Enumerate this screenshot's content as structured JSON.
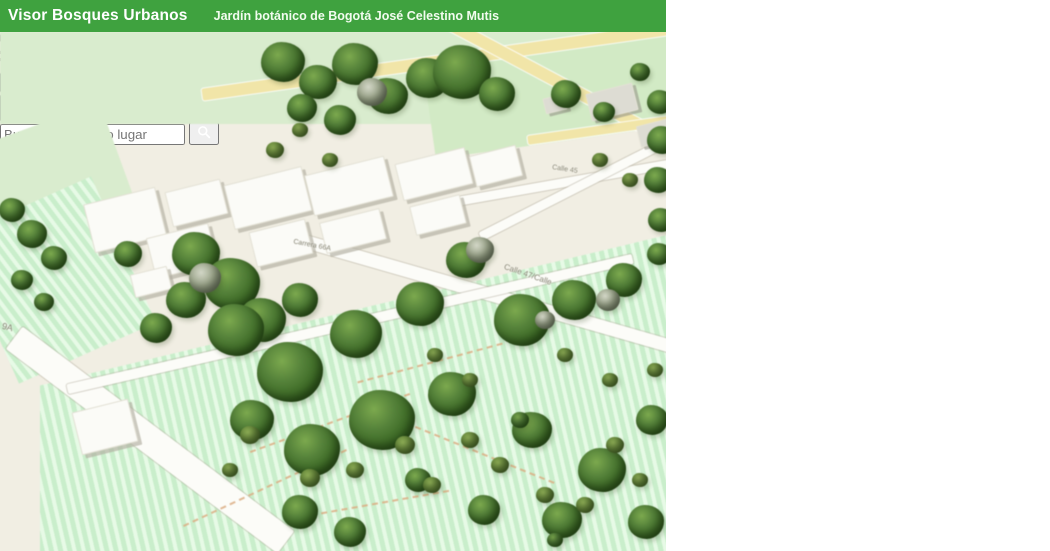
{
  "header": {
    "app_title": "Visor Bosques Urbanos",
    "map_title": "Jardín botánico de Bogotá José Celestino Mutis",
    "bar_color": "#3fa23f"
  },
  "search": {
    "placeholder": "cción o lugar",
    "sources_icon": "search-sources-icon",
    "caret_icon": "chevron-down-icon",
    "clear_icon": "clear-selection-icon",
    "submit_icon": "magnifier-icon"
  },
  "secondary_search": {
    "placeholder": "Buscar dirección o lugar",
    "submit_icon": "magnifier-icon"
  },
  "toolbar": {
    "buttons": [
      {
        "name": "measure-button",
        "icon": "ruler-icon",
        "color": "#44a543",
        "active": false
      },
      {
        "name": "search-tool-button",
        "icon": "magnifier-sparkle-icon",
        "color": "#2d5c2c",
        "active": true
      },
      {
        "name": "save-button",
        "icon": "save-disk-icon",
        "color": "#3f9e3e",
        "active": false
      }
    ]
  },
  "map": {
    "street_labels": [
      {
        "text": "Calle 45",
        "x": 552,
        "y": 134,
        "rot": 9,
        "size": 7
      },
      {
        "text": "Calle 47/Calle",
        "x": 503,
        "y": 238,
        "rot": 19,
        "size": 8
      },
      {
        "text": "Carrera 66A",
        "x": 293,
        "y": 210,
        "rot": 11,
        "size": 7
      },
      {
        "text": "9A",
        "x": 2,
        "y": 290,
        "rot": 14,
        "size": 9
      }
    ],
    "roads": [
      [
        435,
        30,
        470,
        12,
        -8,
        "y"
      ],
      [
        562,
        52,
        290,
        12,
        28,
        "y"
      ],
      [
        612,
        96,
        170,
        9,
        -8,
        "y"
      ],
      [
        490,
        262,
        440,
        13,
        16,
        "w"
      ],
      [
        150,
        408,
        340,
        28,
        37,
        "w"
      ],
      [
        565,
        150,
        250,
        9,
        -10,
        "w"
      ],
      [
        583,
        152,
        230,
        9,
        -27,
        "w"
      ],
      [
        350,
        292,
        580,
        10,
        -13,
        "w"
      ]
    ],
    "trails": [
      [
        330,
        390,
        170,
        -20
      ],
      [
        430,
        330,
        150,
        -15
      ],
      [
        265,
        455,
        180,
        -25
      ],
      [
        480,
        420,
        160,
        22
      ],
      [
        380,
        470,
        140,
        -10
      ]
    ],
    "buildings": [
      [
        88,
        163,
        72,
        48,
        "w"
      ],
      [
        150,
        198,
        62,
        40,
        "w"
      ],
      [
        168,
        153,
        55,
        34,
        "w"
      ],
      [
        228,
        143,
        78,
        44,
        "w"
      ],
      [
        308,
        133,
        80,
        40,
        "w"
      ],
      [
        398,
        123,
        70,
        36,
        "w"
      ],
      [
        252,
        193,
        56,
        34,
        "w"
      ],
      [
        322,
        183,
        60,
        30,
        "w"
      ],
      [
        412,
        168,
        50,
        28,
        "w"
      ],
      [
        472,
        118,
        46,
        30,
        "w"
      ],
      [
        132,
        238,
        36,
        22,
        "w"
      ],
      [
        76,
        373,
        56,
        42,
        "w"
      ],
      [
        588,
        56,
        46,
        26,
        "g"
      ],
      [
        638,
        90,
        32,
        20,
        "g"
      ],
      [
        544,
        64,
        20,
        14,
        "g"
      ]
    ],
    "trees": [
      [
        283,
        30,
        22,
        "d"
      ],
      [
        318,
        50,
        19,
        "d"
      ],
      [
        355,
        32,
        23,
        "d"
      ],
      [
        388,
        64,
        20,
        "d"
      ],
      [
        428,
        46,
        22,
        "d"
      ],
      [
        462,
        40,
        29,
        "d"
      ],
      [
        497,
        62,
        18,
        "d"
      ],
      [
        340,
        88,
        16,
        "d"
      ],
      [
        302,
        76,
        15,
        "d"
      ],
      [
        372,
        60,
        15,
        "g"
      ],
      [
        566,
        62,
        15,
        "d"
      ],
      [
        604,
        80,
        11,
        "d"
      ],
      [
        640,
        40,
        10,
        "d"
      ],
      [
        660,
        70,
        13,
        "d"
      ],
      [
        662,
        108,
        15,
        "d"
      ],
      [
        658,
        148,
        14,
        "d"
      ],
      [
        661,
        188,
        13,
        "d"
      ],
      [
        659,
        222,
        12,
        "d"
      ],
      [
        12,
        178,
        13,
        "d"
      ],
      [
        32,
        202,
        15,
        "d"
      ],
      [
        54,
        226,
        13,
        "d"
      ],
      [
        22,
        248,
        11,
        "d"
      ],
      [
        44,
        270,
        10,
        "d"
      ],
      [
        196,
        222,
        24,
        "d"
      ],
      [
        232,
        252,
        28,
        "d"
      ],
      [
        186,
        268,
        20,
        "d"
      ],
      [
        262,
        288,
        24,
        "d"
      ],
      [
        300,
        268,
        18,
        "d"
      ],
      [
        156,
        296,
        16,
        "d"
      ],
      [
        128,
        222,
        14,
        "d"
      ],
      [
        205,
        246,
        16,
        "g"
      ],
      [
        236,
        298,
        28,
        "d"
      ],
      [
        290,
        340,
        33,
        "d"
      ],
      [
        356,
        302,
        26,
        "d"
      ],
      [
        420,
        272,
        24,
        "d"
      ],
      [
        466,
        228,
        20,
        "d"
      ],
      [
        522,
        288,
        28,
        "d"
      ],
      [
        574,
        268,
        22,
        "d"
      ],
      [
        624,
        248,
        18,
        "d"
      ],
      [
        480,
        218,
        14,
        "g"
      ],
      [
        608,
        268,
        12,
        "g"
      ],
      [
        545,
        288,
        10,
        "g"
      ],
      [
        382,
        388,
        33,
        "d"
      ],
      [
        312,
        418,
        28,
        "d"
      ],
      [
        252,
        388,
        22,
        "d"
      ],
      [
        452,
        362,
        24,
        "d"
      ],
      [
        532,
        398,
        20,
        "d"
      ],
      [
        602,
        438,
        24,
        "d"
      ],
      [
        652,
        388,
        16,
        "d"
      ],
      [
        562,
        488,
        20,
        "d"
      ],
      [
        484,
        478,
        16,
        "d"
      ],
      [
        418,
        448,
        13,
        "d"
      ],
      [
        646,
        490,
        18,
        "d"
      ],
      [
        300,
        480,
        18,
        "d"
      ],
      [
        350,
        500,
        16,
        "d"
      ],
      [
        250,
        403,
        10,
        "b"
      ],
      [
        310,
        446,
        10,
        "b"
      ],
      [
        355,
        438,
        9,
        "b"
      ],
      [
        405,
        413,
        10,
        "b"
      ],
      [
        432,
        453,
        9,
        "b"
      ],
      [
        470,
        408,
        9,
        "b"
      ],
      [
        500,
        433,
        9,
        "b"
      ],
      [
        545,
        463,
        9,
        "b"
      ],
      [
        585,
        473,
        9,
        "b"
      ],
      [
        615,
        413,
        9,
        "b"
      ],
      [
        640,
        448,
        8,
        "b"
      ],
      [
        470,
        348,
        8,
        "b"
      ],
      [
        435,
        323,
        8,
        "b"
      ],
      [
        565,
        323,
        8,
        "b"
      ],
      [
        610,
        348,
        8,
        "b"
      ],
      [
        655,
        338,
        8,
        "b"
      ],
      [
        230,
        438,
        8,
        "b"
      ],
      [
        275,
        118,
        9,
        "b"
      ],
      [
        300,
        98,
        8,
        "b"
      ],
      [
        330,
        128,
        8,
        "b"
      ],
      [
        600,
        128,
        8,
        "b"
      ],
      [
        630,
        148,
        8,
        "b"
      ],
      [
        520,
        388,
        9,
        "gb"
      ],
      [
        555,
        508,
        8,
        "gb"
      ]
    ],
    "palette": {
      "map_base": "#f1eee3",
      "park_green": "#d9ecce",
      "field_mint": "#c9eecb",
      "road_yellow": "#f1e5a8",
      "road_white": "#fcfcf8",
      "tree_dark": "#35621f",
      "trail_tan": "#dcae84"
    }
  },
  "photo": {
    "subject_icon": "tree-canopy-photo",
    "palette": {
      "canopy_green": "#8fae6b",
      "canopy_dark": "#32482a",
      "sky_light": "#f0f4ea",
      "trunk_brown": "#8d7466",
      "branch_dark": "#242b1c",
      "dry_foliage": "#6e5a3a"
    }
  }
}
